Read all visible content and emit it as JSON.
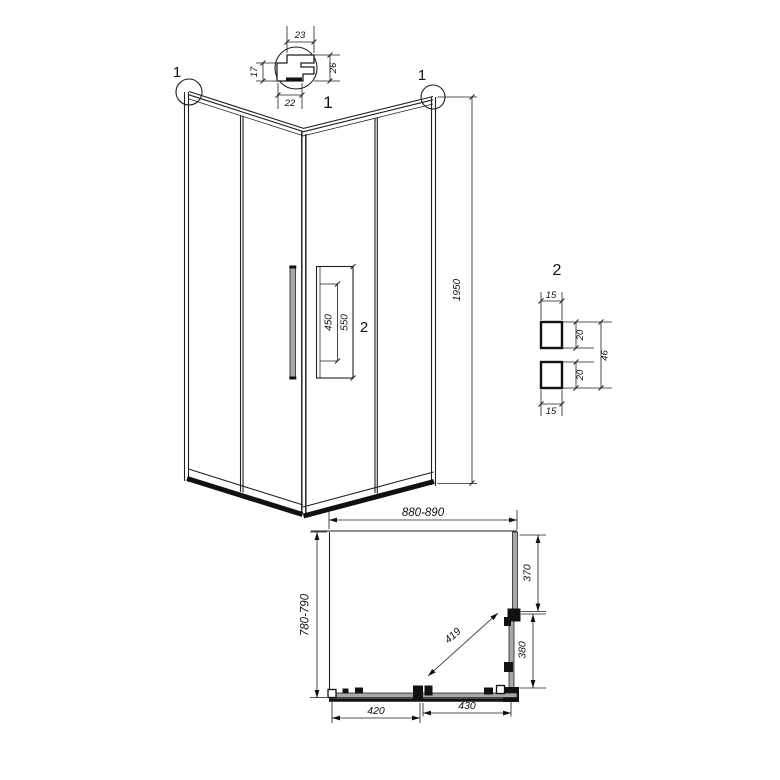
{
  "detail1": {
    "label": "1",
    "dim_top": "23",
    "dim_left": "17",
    "dim_right": "26",
    "dim_bottom": "22"
  },
  "elevation": {
    "callout_left": "1",
    "callout_right": "1",
    "dim_height": "1950",
    "dim_handle_holes": "450",
    "dim_handle_length": "550",
    "handle_detail_ref": "2"
  },
  "detail2": {
    "label": "2",
    "dim_top_width": "15",
    "dim_upper_depth": "20",
    "dim_total_depth": "46",
    "dim_lower_depth": "20",
    "dim_bottom_width": "15"
  },
  "plan": {
    "dim_width": "880-890",
    "dim_depth": "780-790",
    "dim_side_fixed": "370",
    "dim_side_door": "380",
    "dim_diagonal": "419",
    "dim_front_door": "420",
    "dim_front_fixed": "430"
  },
  "colors": {
    "line": "#1f1f1f",
    "dark": "#111111",
    "grey": "#a8a8a8",
    "background": "#ffffff"
  }
}
